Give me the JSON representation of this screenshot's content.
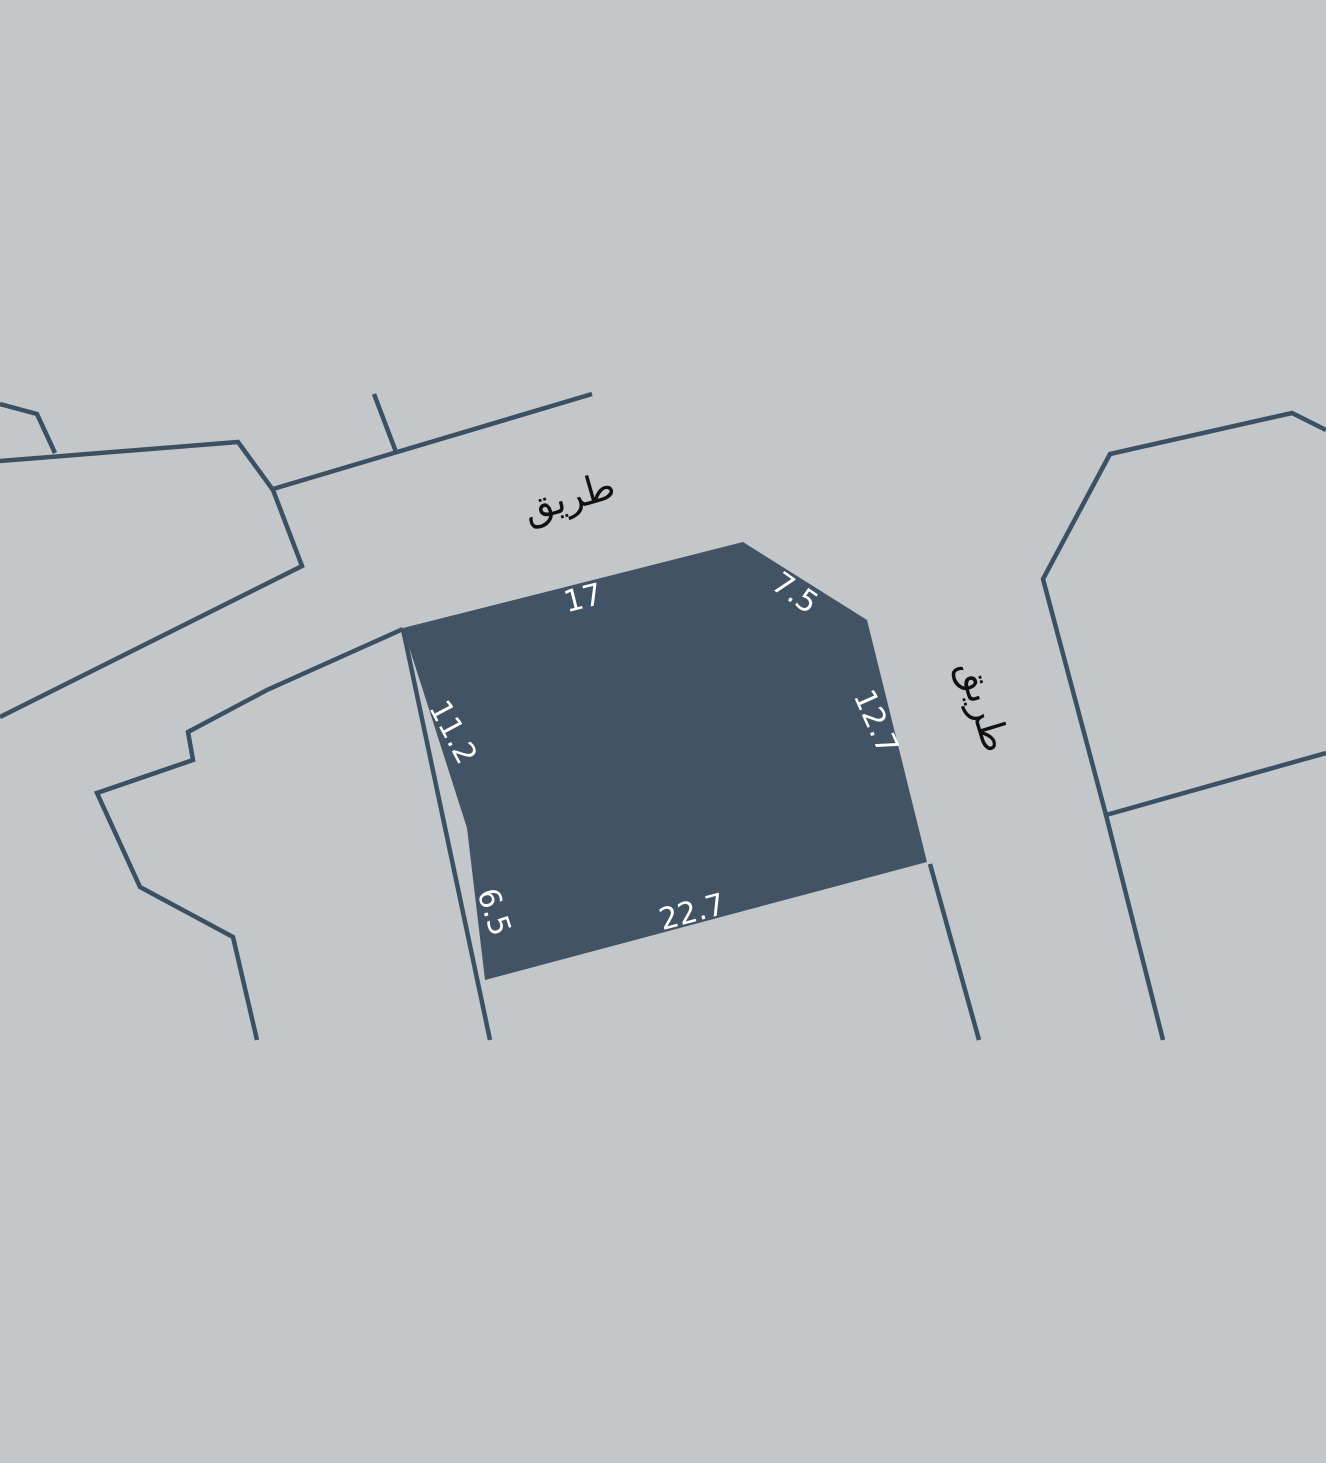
{
  "map": {
    "background_color": "#c3c7ca",
    "line_color": "#3c5064",
    "selected_plot": {
      "fill_color": "#425365",
      "dimension_label_color": "#ffffff",
      "dimensions": {
        "top": "17",
        "top_right": "7.5",
        "right": "12.7",
        "bottom": "22.7",
        "bottom_left": "6.5",
        "left": "11.2"
      }
    },
    "road_labels": {
      "text_color": "#111111",
      "top": "طريق",
      "right": "طريق"
    }
  }
}
